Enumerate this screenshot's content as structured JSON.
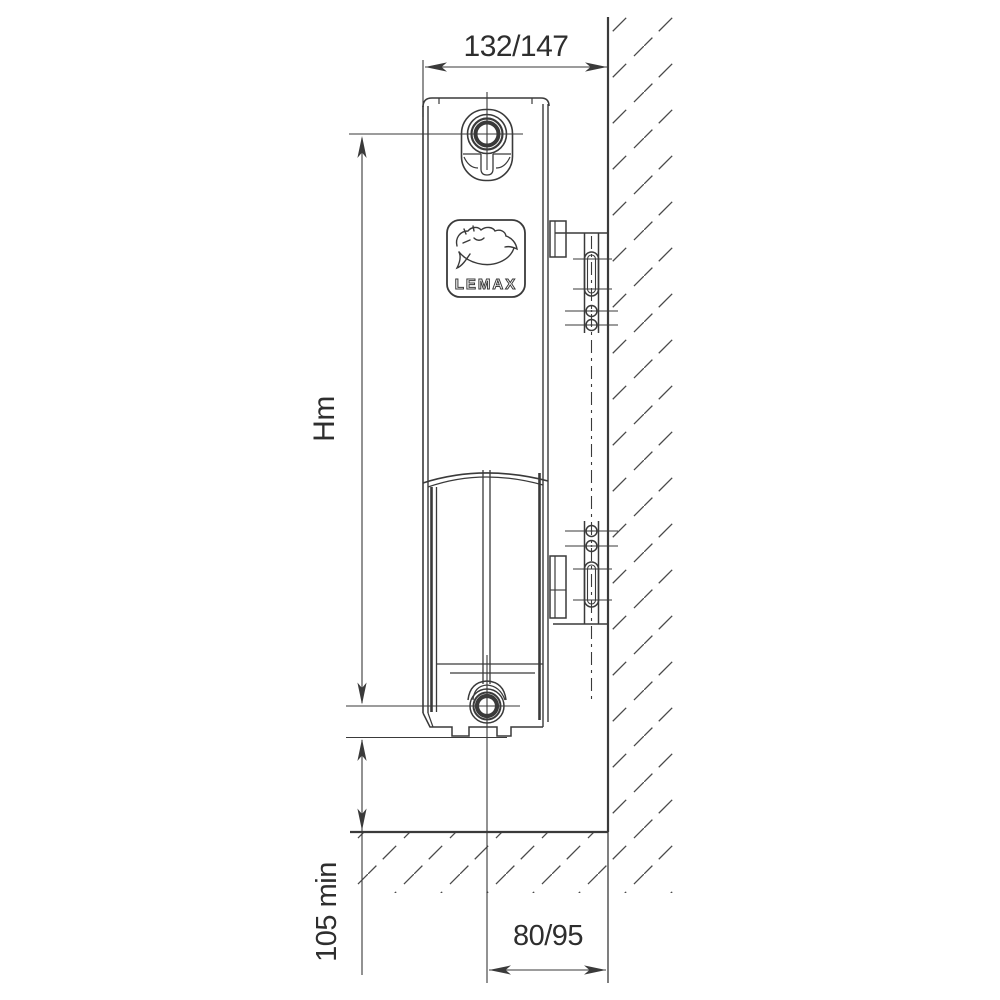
{
  "drawing": {
    "brand": "LEMAX",
    "logo_icon": "leaping-animal-icon",
    "colors": {
      "line": "#3a3a3a",
      "text": "#2e2e2e",
      "background": "#ffffff"
    },
    "dimensions": {
      "depth_top": "132/147",
      "mounting_height": "Hm",
      "floor_clearance_min": "105 min",
      "pipe_center_to_wall": "80/95"
    }
  }
}
